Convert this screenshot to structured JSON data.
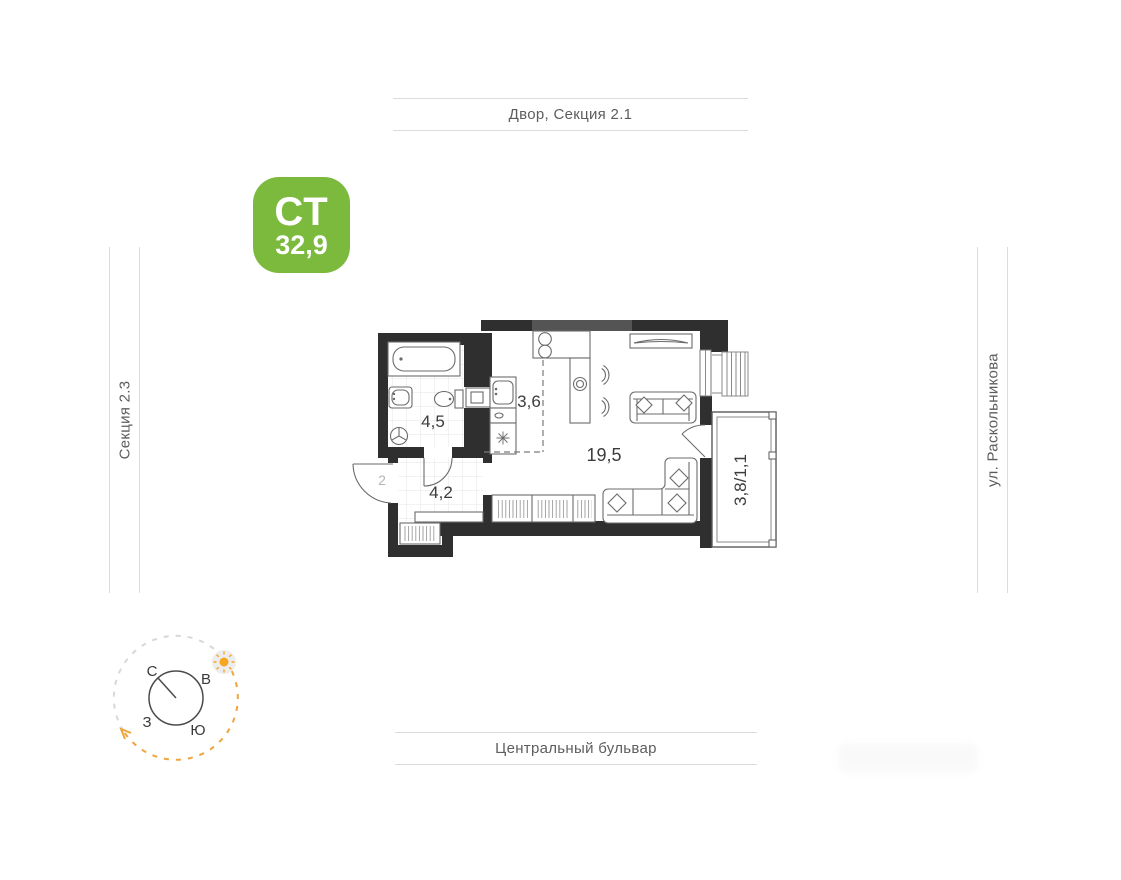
{
  "unit_badge": {
    "type": "СТ",
    "area": "32,9",
    "bg_color": "#7cba3d",
    "text_color": "#ffffff"
  },
  "surroundings": {
    "top": "Двор, Секция 2.1",
    "bottom": "Центральный бульвар",
    "left": "Секция 2.3",
    "right": "ул. Раскольникова"
  },
  "rooms": {
    "bathroom": "4,5",
    "kitchen": "3,6",
    "living": "19,5",
    "hallway": "4,2",
    "balcony": "3,8/1,1"
  },
  "entrance_label": "2",
  "compass": {
    "n": "С",
    "e": "В",
    "s": "Ю",
    "w": "З"
  },
  "colors": {
    "walls": "#2f2f2f",
    "accent_green": "#7cba3d",
    "sun_orange": "#f5a623",
    "dash_gray": "#d8d8d8",
    "street_line": "#dcdcdc"
  }
}
